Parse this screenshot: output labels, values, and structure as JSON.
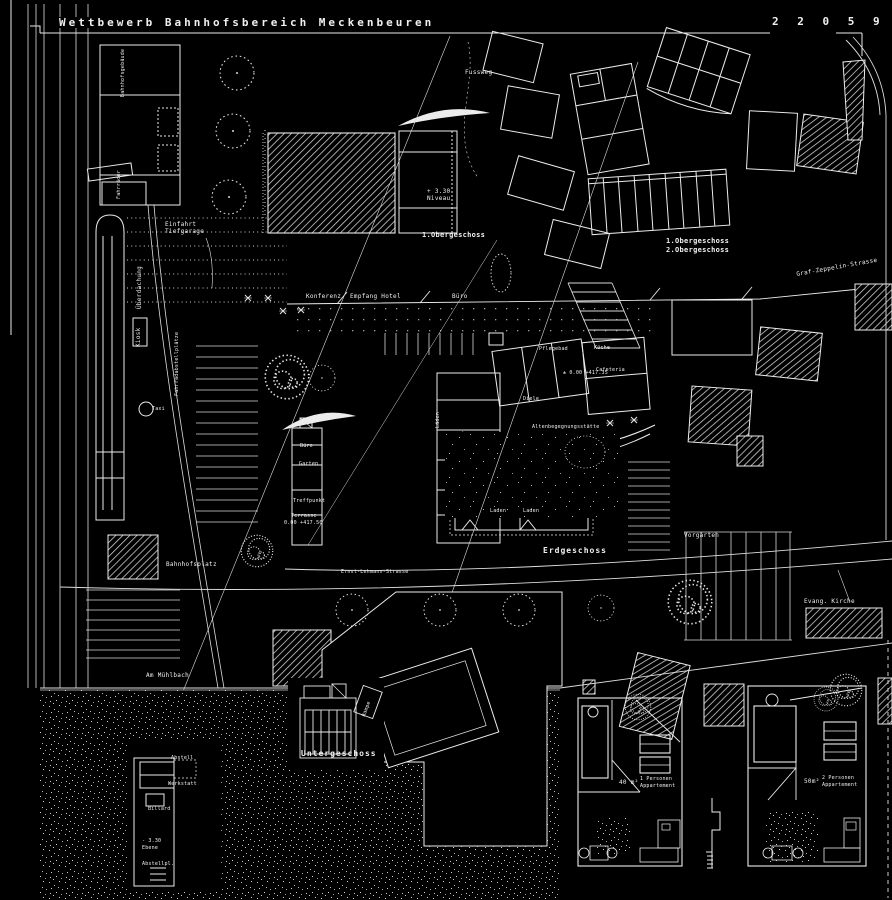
{
  "title": "Wettbewerb Bahnhofsbereich Meckenbeuren",
  "plan_number": "2 2 0 5 9 0",
  "colors": {
    "background": "#000000",
    "line": "#ececec",
    "hatch": "#dcdcdc"
  },
  "floors": {
    "erdgeschoss": "Erdgeschoss",
    "untergeschoss": "Untergeschoss",
    "og1_left": "1.Obergeschoss",
    "og1_right": "1.Obergeschoss",
    "og2_right": "2.Obergeschoss",
    "niveau_line1": "+ 3.30",
    "niveau_line2": "Niveau",
    "level_eg": "± 0.00 +417.35",
    "level_terrasse": "0.00 +417.50",
    "ebene_line1": "- 3.30",
    "ebene_line2": "Ebene"
  },
  "streets": {
    "graf_zeppelin": "Graf-Zeppelin-Strasse",
    "ernst_lehmann": "Ernst-Lehmann-Strasse",
    "fussweg": "Fussweg",
    "am_muehlbach": "Am Mühlbach",
    "bahnhofsplatz": "Bahnhofsplatz"
  },
  "site": {
    "vorgaerten": "Vorgärten",
    "evang_kirche": "Evang. Kirche",
    "einfahrt_line1": "Einfahrt",
    "einfahrt_line2": "Tiefgarage",
    "ueberdachung": "Überdachung",
    "kiosk": "Kiosk",
    "taxi": "Taxi",
    "fahrradabstellplaetze": "Fahrradabstellplätze",
    "bahnhofsgebaeude": "Bahnhofsgebäude",
    "fahrraeder": "Fahrräder",
    "rampe": "Rampe"
  },
  "rooms": {
    "konferenz": "Konferenz",
    "empfang_hotel": "Empfang Hotel",
    "buero": "Büro",
    "pflegebad": "Pflegebad",
    "kueche": "Küche",
    "cafeteria": "Cafeteria",
    "diele": "Diele",
    "altenbegegnung": "Altenbegegnungsstätte",
    "laeden": "Läden",
    "laden_1": "Laden",
    "laden_2": "Laden",
    "buero_klein": "Büro",
    "garten": "Garten",
    "treffpunkt": "Treffpunkt",
    "terrasse": "Terrasse",
    "abstell": "Abstell",
    "werkstatt": "Werkstatt",
    "billard": "Billard",
    "abstellplatz": "Abstellpl."
  },
  "apartments": {
    "apt1_area": "40 m²",
    "apt1_line1": "1 Personen",
    "apt1_line2": "Appartement",
    "apt2_area": "50m²",
    "apt2_line1": "2 Personen",
    "apt2_line2": "Appartement"
  }
}
